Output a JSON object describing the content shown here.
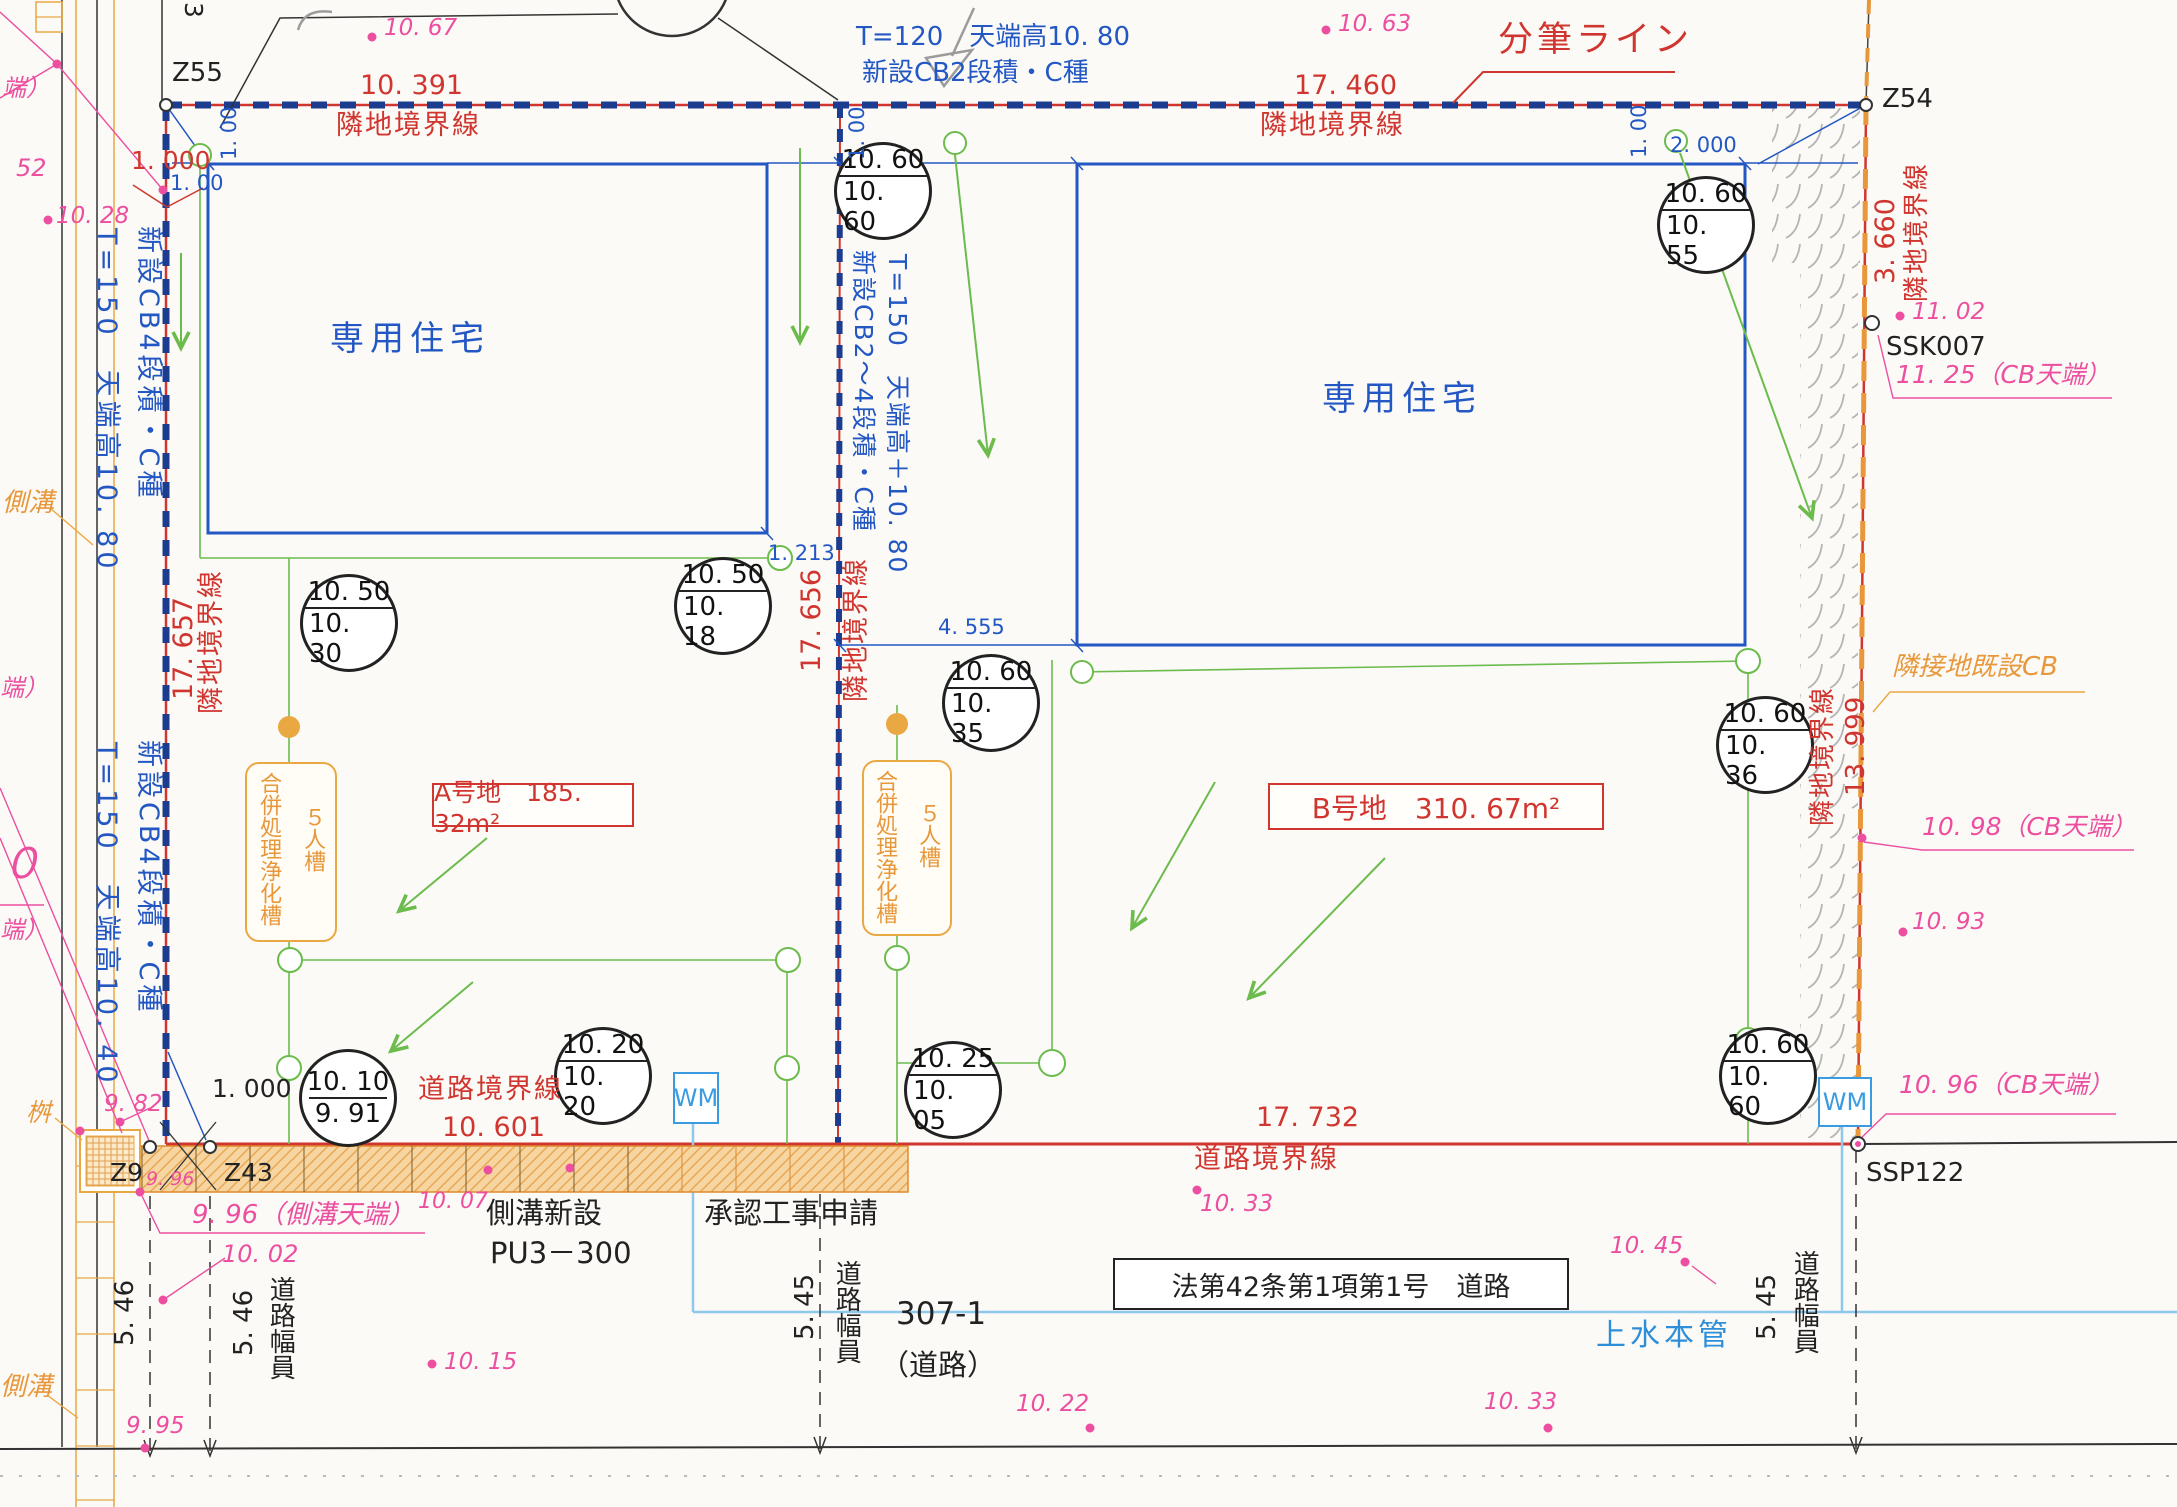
{
  "boundaries": {
    "top_label_left": "隣地境界線",
    "top_dim_left": "10. 391",
    "top_label_right": "隣地境界線",
    "top_dim_right": "17. 460",
    "bunpitsu_line": "分筆ライン",
    "left_dim": "17. 657",
    "left_label": "隣地境界線",
    "divider_dim": "17. 656",
    "divider_label": "隣地境界線",
    "right_top_dim": "3. 660",
    "right_top_label": "隣地境界線",
    "right_mid_label": "隣地境界線",
    "right_mid_dim": "13. 999",
    "road_label_left": "道路境界線",
    "road_dim_left": "10. 601",
    "road_dim_right": "17. 732",
    "road_label_right": "道路境界線"
  },
  "points": {
    "z55": "Z55",
    "z54": "Z54",
    "z9": "Z9",
    "z43": "Z43",
    "ssk007": "SSK007",
    "ssp122": "SSP122"
  },
  "walls": {
    "top_note1": "T=120　天端高10. 80",
    "top_note2": "新設CB2段積・C種",
    "left_upper1": "T=150　天端高10. 80",
    "left_upper2": "新設CB4段積・C種",
    "left_lower1": "T=150　天端高10. 40",
    "left_lower2": "新設CB4段積・C種",
    "divider1": "T=150　天端高＋10. 80",
    "divider2": "新設CB2～4段積・C種",
    "existing_cb": "隣接地既設CB"
  },
  "plots": {
    "a_house": "専用住宅",
    "b_house": "専用住宅",
    "a_area": "A号地　185. 32m²",
    "b_area": "B号地　310. 67m²",
    "jokaso": "合併処理浄化槽",
    "jokaso_size": "５人槽"
  },
  "dims": {
    "d1000_red": "1. 000",
    "d100_v1": "1. 00",
    "d100_h": "1. 00",
    "d100_v2": "1. 00",
    "d100_v3": "1. 00",
    "d2000": "2. 000",
    "d1213": "1. 213",
    "d4555": "4. 555",
    "d1000_blk": "1. 000"
  },
  "road": {
    "sokko_shinsetsu": "側溝新設",
    "pu3": "PU3－300",
    "shonin": "承認工事申請",
    "lot": "307-1",
    "lot_kind": "（道路）",
    "law": "法第42条第1項第1号　道路",
    "water_main": "上水本管",
    "w546a": "5. 46",
    "w546b": "5. 46",
    "w545a": "5. 45",
    "w545b": "5. 45",
    "fukuin": "道路幅員",
    "wm": "WM"
  },
  "levels": {
    "circles": [
      {
        "top": "10. 60",
        "bottom": "10. 60"
      },
      {
        "top": "10. 60",
        "bottom": "10. 55"
      },
      {
        "top": "10. 50",
        "bottom": "10. 30"
      },
      {
        "top": "10. 50",
        "bottom": "10. 18"
      },
      {
        "top": "10. 60",
        "bottom": "10. 35"
      },
      {
        "top": "10. 60",
        "bottom": "10. 36"
      },
      {
        "top": "10. 10",
        "bottom": "9. 91"
      },
      {
        "top": "10. 20",
        "bottom": "10. 20"
      },
      {
        "top": "10. 25",
        "bottom": "10. 05"
      },
      {
        "top": "10. 60",
        "bottom": "10. 60"
      }
    ]
  },
  "spot_heights": {
    "p1067": "10. 67",
    "p1063": "10. 63",
    "p1028": "10. 28",
    "p52": "52",
    "p1102": "11. 02",
    "p1125": "11. 25（CB天端）",
    "p1098": "10. 98（CB天端）",
    "p1093": "10. 93",
    "p1096": "10. 96（CB天端）",
    "p982": "9. 82",
    "p996s": "9. 96",
    "p996": "9. 96（側溝天端）",
    "p1002": "10. 02",
    "p995": "9. 95",
    "p1007": "10. 07",
    "p1015": "10. 15",
    "p1022": "10. 22",
    "p1033a": "10. 33",
    "p1033b": "10. 33",
    "p1045": "10. 45"
  },
  "margins": {
    "sokko1": "側溝",
    "sokko2": "側溝",
    "masu": "桝",
    "frag1": "端）",
    "frag2": "端）",
    "frag3": "０",
    "frag4": "端）",
    "note3": "3"
  }
}
